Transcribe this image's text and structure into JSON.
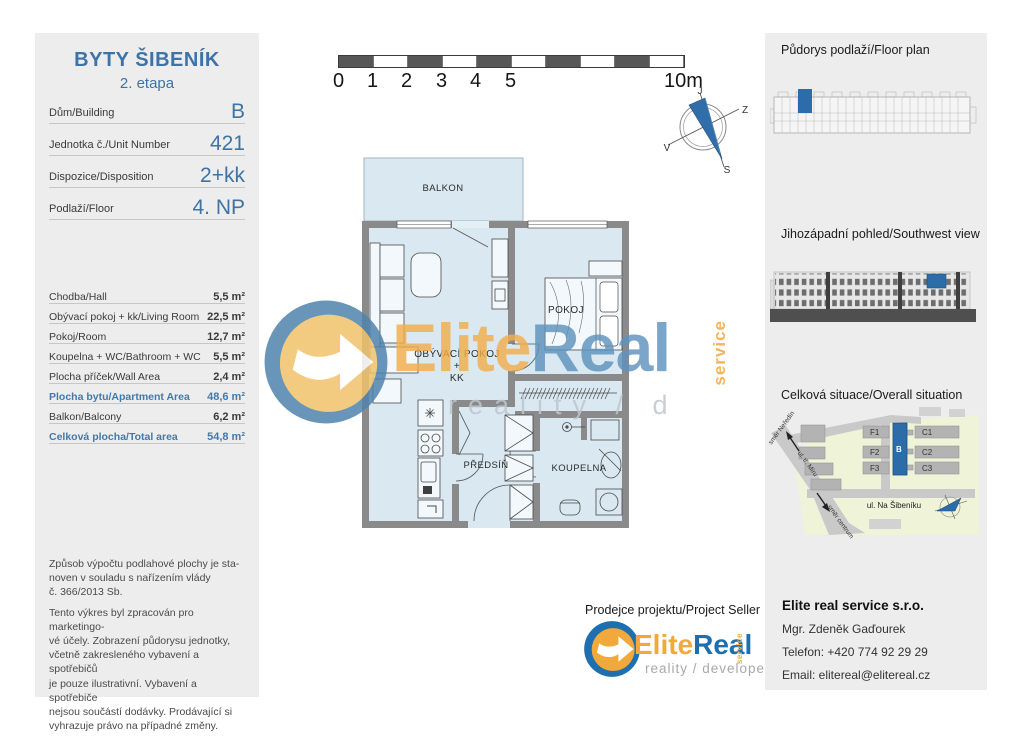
{
  "header": {
    "title": "BYTY ŠIBENÍK",
    "subtitle": "2. etapa"
  },
  "unit_info": [
    {
      "label": "Dům/Building",
      "value": "B"
    },
    {
      "label": "Jednotka č./Unit Number",
      "value": "421"
    },
    {
      "label": "Dispozice/Disposition",
      "value": "2+kk"
    },
    {
      "label": "Podlaží/Floor",
      "value": "4. NP"
    }
  ],
  "areas": [
    {
      "label": "Chodba/Hall",
      "value": "5,5 m²"
    },
    {
      "label": "Obývací pokoj + kk/Living Room",
      "value": "22,5 m²"
    },
    {
      "label": "Pokoj/Room",
      "value": "12,7 m²"
    },
    {
      "label": "Koupelna + WC/Bathroom + WC",
      "value": "5,5 m²"
    },
    {
      "label": "Plocha příček/Wall Area",
      "value": "2,4 m²"
    },
    {
      "label": "Plocha bytu/Apartment Area",
      "value": "48,6 m²"
    },
    {
      "label": "Balkon/Balcony",
      "value": "6,2 m²"
    },
    {
      "label": "Celková plocha/Total area",
      "value": "54,8 m²"
    }
  ],
  "disclaimer": {
    "p1": "Způsob výpočtu podlahové plochy je sta-\nnoven v souladu s nařízením vlády\nč. 366/2013 Sb.",
    "p2": "Tento výkres byl zpracován pro marketingo-\nvé účely. Zobrazení půdorysu jednotky,\nvčetně zakresleného vybavení a spotřebičů\nje pouze ilustrativní. Vybavení a spotřebiče\nnejsou součástí dodávky. Prodávající si\nvyhrazuje právo na případné změny."
  },
  "scale_bar": {
    "ticks": [
      "0",
      "1",
      "2",
      "3",
      "4",
      "5"
    ],
    "end": "10m"
  },
  "compass": {
    "top": "J",
    "right": "Z",
    "left": "V",
    "bottom": "S"
  },
  "fp": {
    "balkon": "BALKON",
    "living1": "OBÝVACÍ POKOJ",
    "living2": "+",
    "living3": "KK",
    "pokoj": "POKOJ",
    "predsin": "PŘEDSÍŇ",
    "koupelna": "KOUPELNA"
  },
  "right_panel": {
    "floor_plan_title": "Půdorys podlaží/Floor plan",
    "view_title": "Jihozápadní pohled/Southwest view",
    "situation_title": "Celková situace/Overall situation"
  },
  "site": {
    "f1": "F1",
    "f2": "F2",
    "f3": "F3",
    "b": "B",
    "c1": "C1",
    "c2": "C2",
    "c3": "C3",
    "street": "ul. Na Šibeníku",
    "dir_up": "směr Neředín",
    "road": "ul. tř. Míru",
    "dir_down": "směr centrum"
  },
  "seller": {
    "heading": "Prodejce projektu/Project Seller"
  },
  "brand": {
    "elite": "Elite",
    "real": "Real",
    "service": "service",
    "tagline": "reality / developer"
  },
  "watermark": {
    "elite": "Elite",
    "real": "Real",
    "service": "service",
    "tagline": "reality / d"
  },
  "contact": {
    "company": "Elite real service s.r.o.",
    "person": "Mgr. Zdeněk Gaďourek",
    "phone": "Telefon: +420 774 92 29 29",
    "email": "Email: elitereal@elitereal.cz"
  },
  "colors": {
    "accent_blue": "#3d73a6",
    "highlight_blue": "#2c6ca8",
    "orange": "#f2a93b",
    "wall_gray": "#8a8a8a",
    "floor_blue": "#d9e8f1"
  }
}
